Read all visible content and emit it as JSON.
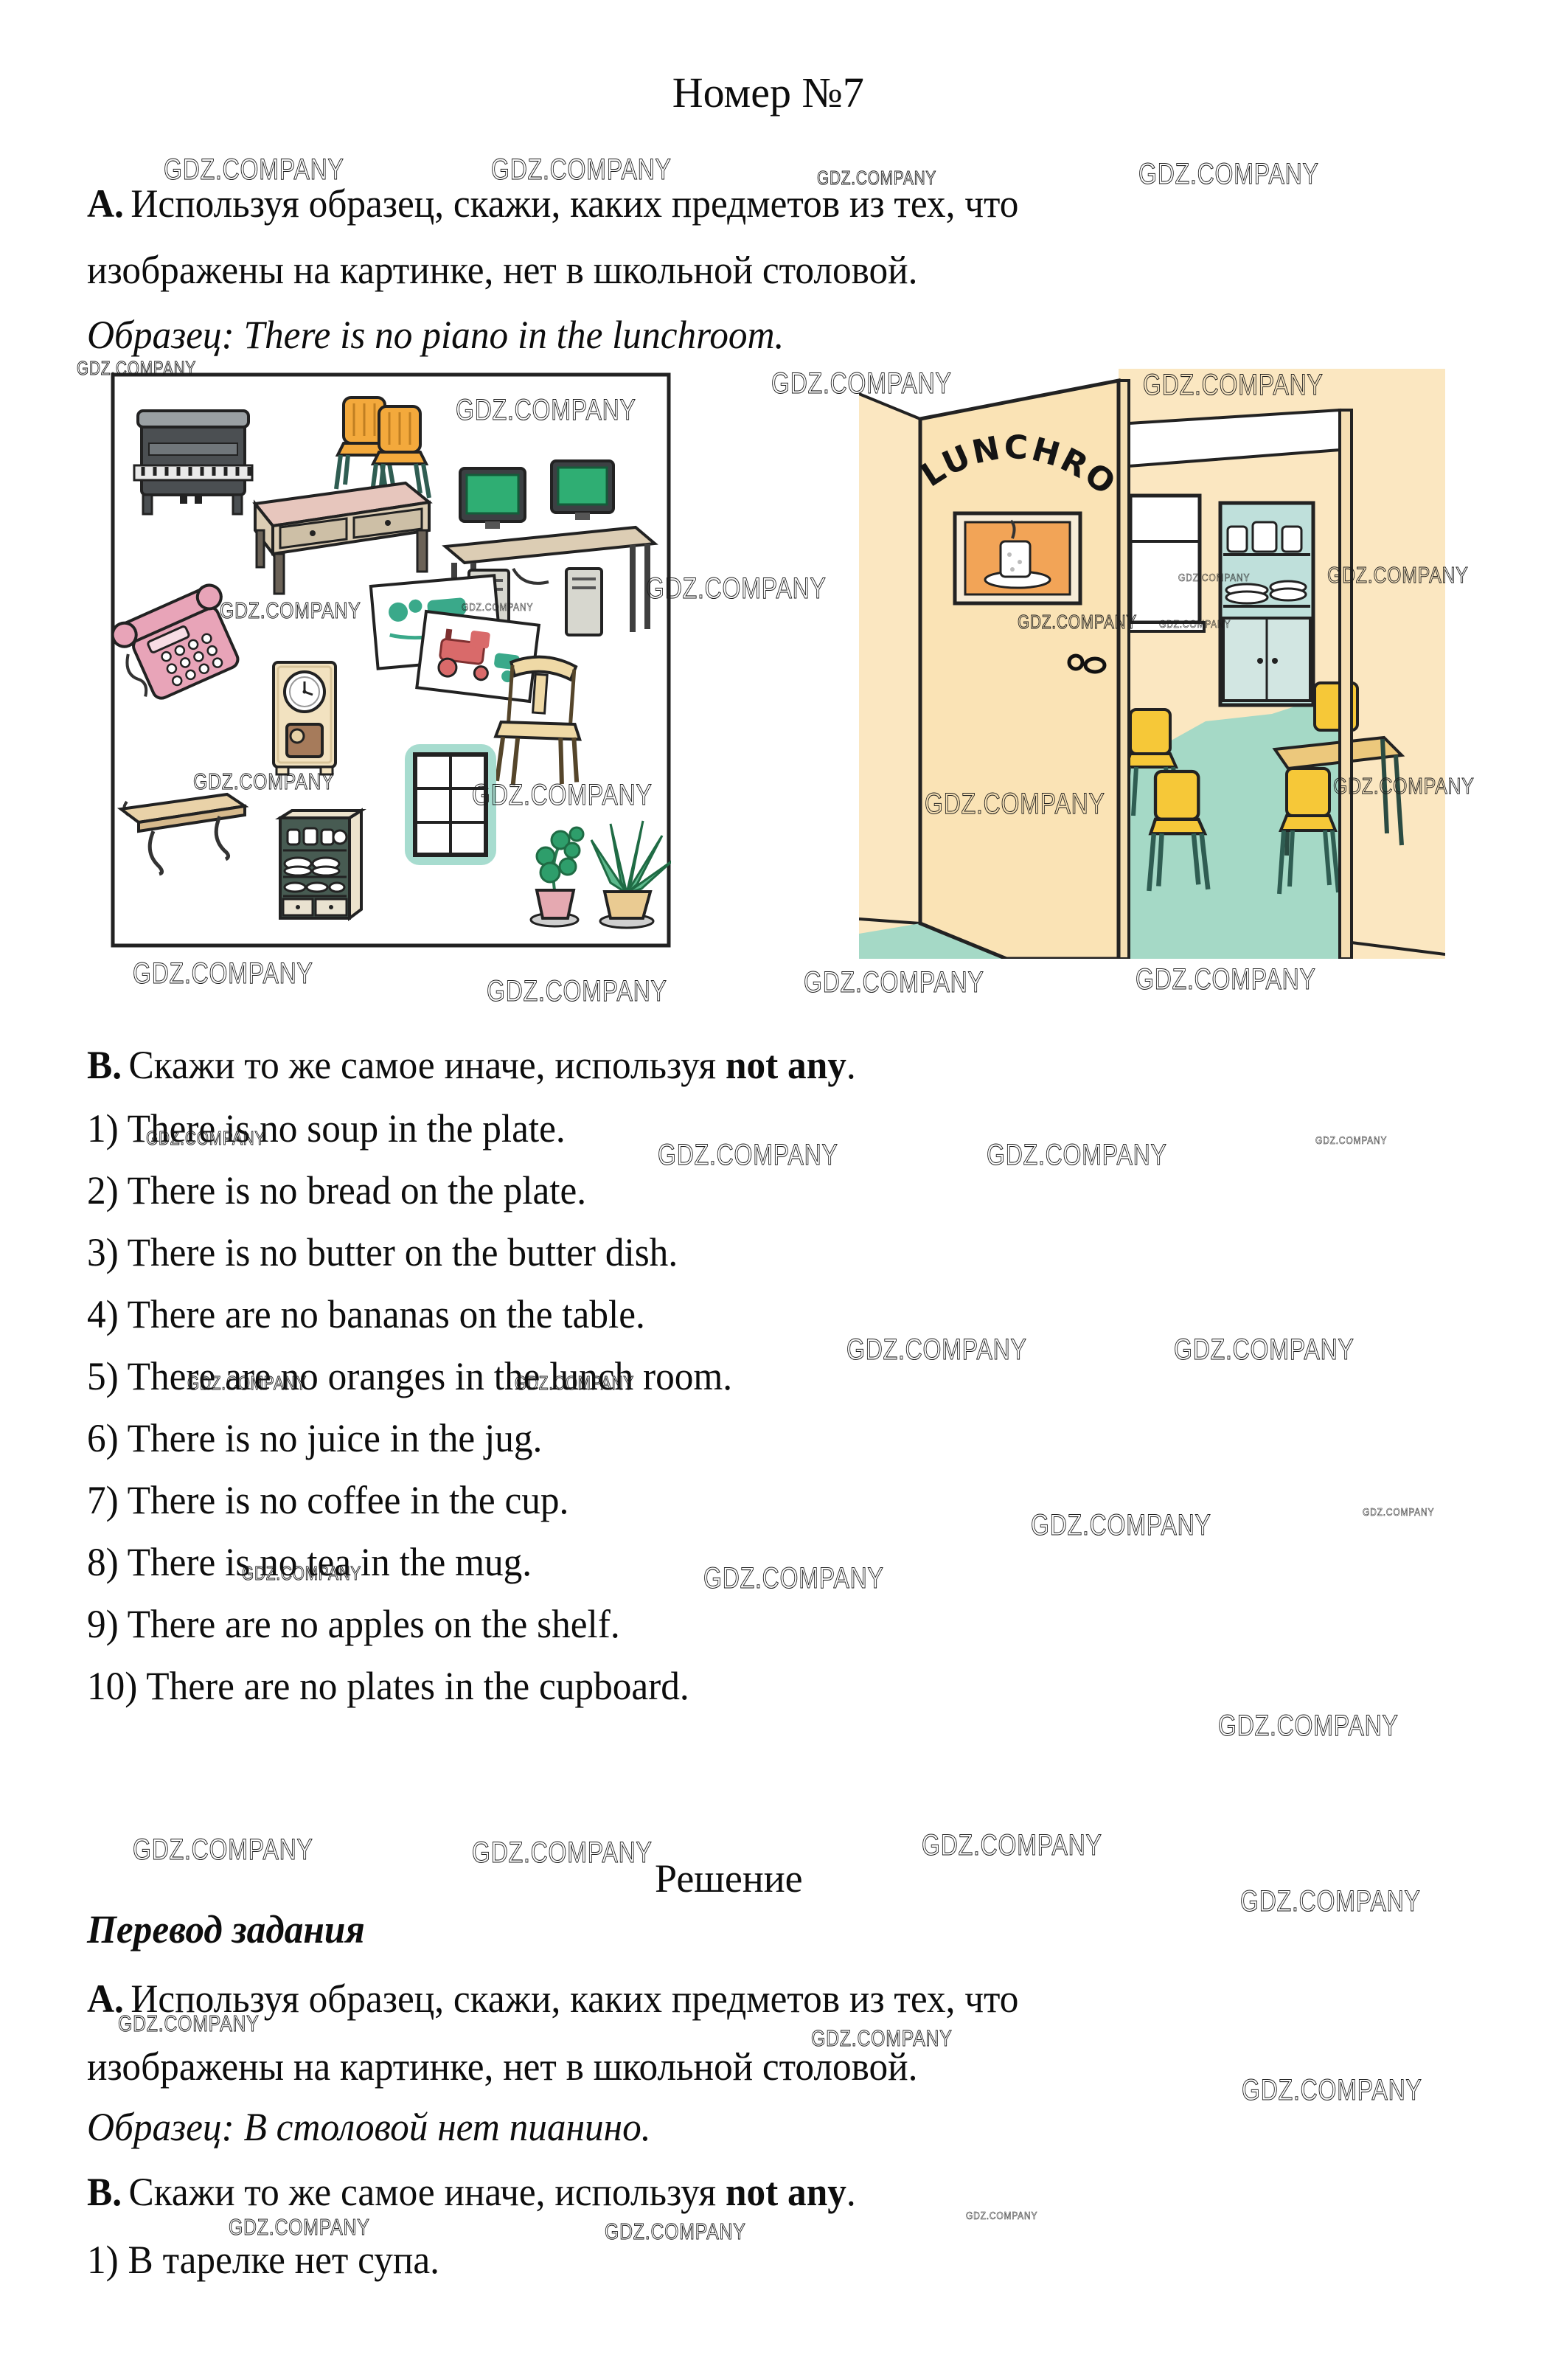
{
  "page": {
    "title": "Номер №7",
    "solution_label": "Решение"
  },
  "task": {
    "a_bold": "А.",
    "a_line1": "Используя образец, скажи, каких предметов из тех, что",
    "a_line2": "изображены на картинке, нет в школьной столовой.",
    "sample_italic": "Образец: There is no piano in the lunchroom.",
    "b_bold": "В.",
    "b_mid": "Скажи то же самое иначе, используя",
    "b_strong": "not any",
    "b_tail": "."
  },
  "listB": {
    "items": [
      "1) There is no soup in the plate.",
      "2) There is no bread on the plate.",
      "3) There is no butter on the butter dish.",
      "4) There are no bananas on the table.",
      "5) There are no oranges in the lunch room.",
      "6) There is no juice in the jug.",
      "7) There is no coffee in the cup.",
      "8) There is no tea in the mug.",
      "9) There are no apples on the shelf.",
      "10) There are no plates in the cupboard."
    ]
  },
  "translation": {
    "heading": "Перевод задания",
    "a_bold": "А.",
    "a_line1": "Используя образец, скажи, каких предметов из тех, что",
    "a_line2": "изображены на картинке, нет в школьной столовой.",
    "sample_italic": "Образец: В столовой нет пианино.",
    "b_bold": "В.",
    "b_mid": "Скажи то же самое иначе, используя",
    "b_strong": "not any",
    "b_tail": ".",
    "item1": "1) В тарелке нет супа."
  },
  "left_picture": {
    "items": [
      "piano",
      "two orange chairs",
      "desk with drawers",
      "two computers on desk",
      "pink telephone",
      "two picture cards",
      "clock",
      "wooden chair",
      "wall shelf",
      "cupboard with dishes",
      "window",
      "two potted plants"
    ]
  },
  "right_picture": {
    "sign": "LUNCHROOM",
    "objects": [
      "open door",
      "picture of cup on saucer",
      "doorway",
      "window",
      "cupboard with dishes",
      "yellow chairs",
      "table",
      "teal floor"
    ]
  },
  "watermarks": {
    "text": "GDZ.COMPANY",
    "instances": [
      [
        222,
        208,
        "l"
      ],
      [
        666,
        208,
        "l"
      ],
      [
        1108,
        226,
        "s"
      ],
      [
        1544,
        214,
        "l"
      ],
      [
        104,
        484,
        "s"
      ],
      [
        1046,
        498,
        "l"
      ],
      [
        1550,
        500,
        "l"
      ],
      [
        618,
        534,
        "l"
      ],
      [
        298,
        810,
        "m"
      ],
      [
        626,
        815,
        "t"
      ],
      [
        876,
        776,
        "l"
      ],
      [
        1380,
        828,
        "s"
      ],
      [
        1598,
        775,
        "t"
      ],
      [
        1572,
        838,
        "t"
      ],
      [
        1800,
        762,
        "m"
      ],
      [
        262,
        1042,
        "m"
      ],
      [
        640,
        1056,
        "l"
      ],
      [
        1254,
        1068,
        "l"
      ],
      [
        1808,
        1048,
        "m"
      ],
      [
        180,
        1298,
        "l"
      ],
      [
        660,
        1322,
        "l"
      ],
      [
        1090,
        1310,
        "l"
      ],
      [
        1540,
        1306,
        "l"
      ],
      [
        198,
        1528,
        "s"
      ],
      [
        892,
        1544,
        "l"
      ],
      [
        1338,
        1544,
        "l"
      ],
      [
        1784,
        1538,
        "t"
      ],
      [
        1148,
        1808,
        "l"
      ],
      [
        1592,
        1808,
        "l"
      ],
      [
        254,
        1860,
        "s"
      ],
      [
        698,
        1860,
        "s"
      ],
      [
        1398,
        2046,
        "l"
      ],
      [
        1848,
        2042,
        "t"
      ],
      [
        328,
        2118,
        "s"
      ],
      [
        954,
        2118,
        "l"
      ],
      [
        1652,
        2318,
        "l"
      ],
      [
        180,
        2486,
        "l"
      ],
      [
        640,
        2490,
        "l"
      ],
      [
        1250,
        2480,
        "l"
      ],
      [
        1682,
        2556,
        "l"
      ],
      [
        160,
        2726,
        "m"
      ],
      [
        1100,
        2746,
        "m"
      ],
      [
        1684,
        2812,
        "l"
      ],
      [
        310,
        3002,
        "m"
      ],
      [
        820,
        3008,
        "m"
      ],
      [
        1310,
        2996,
        "t"
      ]
    ]
  },
  "colors": {
    "paper": "#ffffff",
    "outline": "#2b2b2b",
    "wall-cream": "#fbe7c1",
    "door-cream": "#fae3b5",
    "floor-teal": "#a5d9c6",
    "chair-yellow": "#f6c838",
    "chair-orange": "#f3a93c",
    "leg-green": "#2f5d52",
    "cupboard-teal": "#bfe0db",
    "frame-orange": "#f2a457",
    "piano-dark": "#4b4f52",
    "piano-lid": "#9aa0a3",
    "desk-tan": "#dccdb4",
    "desk-top-pink": "#e7c6bd",
    "screen-green": "#2fae73",
    "tower-gray": "#d7d7cf",
    "monitor-dark": "#3c4043",
    "phone-pink": "#e8a4b8",
    "clock-cream": "#f2e2c0",
    "clock-door-brown": "#a67b5b",
    "chair-beige": "#efd9a6",
    "shelf-tan": "#e9d2a8",
    "cupboard2-green": "#475b52",
    "cupboard2-side": "#ede3cc",
    "window-halo": "#a7dccf",
    "plant-green": "#2e9e6b",
    "pot-pink": "#e5a9b1",
    "pot-tan": "#eacb92",
    "card-red": "#d96a6a",
    "card-green": "#3aa98a"
  }
}
